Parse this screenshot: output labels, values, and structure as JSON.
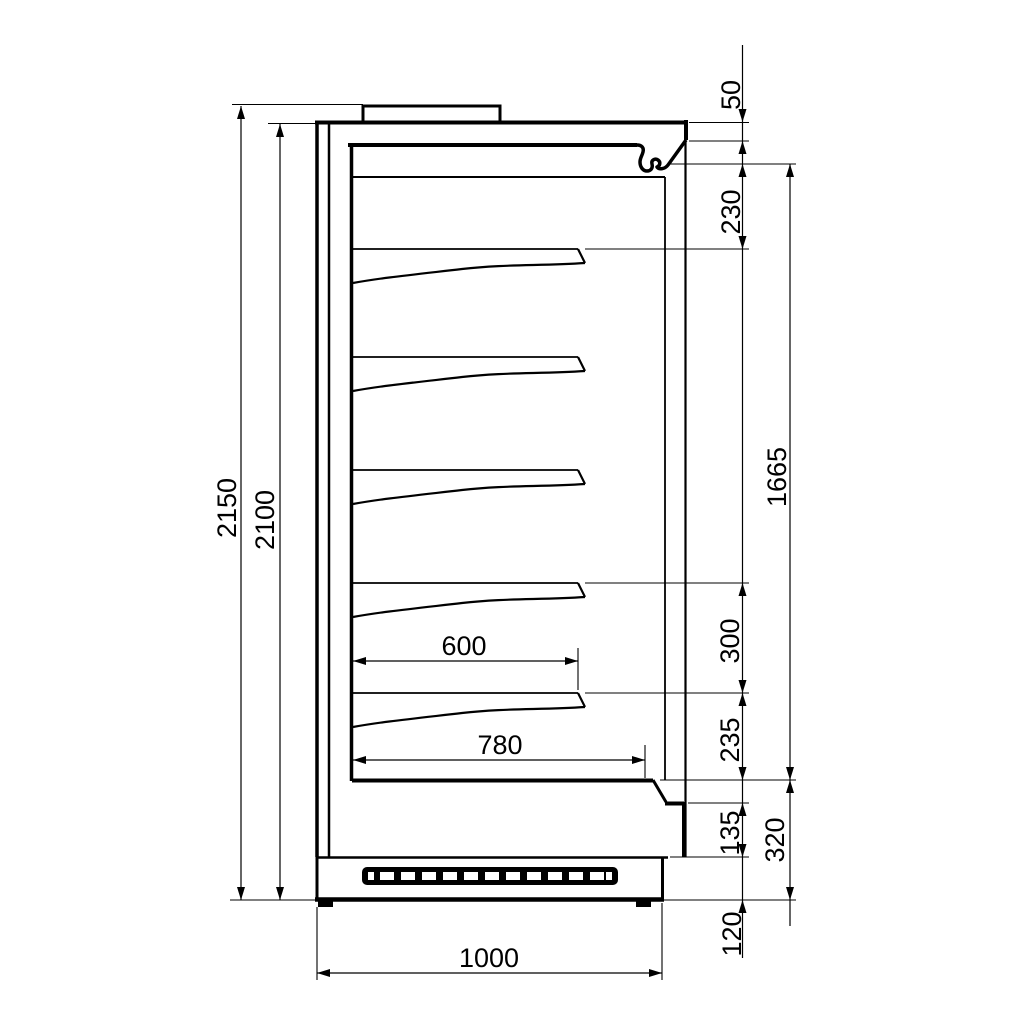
{
  "drawing": {
    "kind": "technical-side-section",
    "colors": {
      "line": "#000000",
      "background": "#ffffff"
    }
  },
  "dimensions": {
    "overall_height": "2150",
    "height_to_canopy": "2100",
    "canopy_fascia": "50",
    "canopy_to_first_shelf": "230",
    "display_opening_height": "1665",
    "shelf_pitch": "300",
    "bottom_shelf_to_deck": "235",
    "front_recess_height": "135",
    "base_section_height": "320",
    "plinth_height": "120",
    "shelf_depth": "600",
    "deck_depth": "780",
    "overall_depth": "1000"
  }
}
